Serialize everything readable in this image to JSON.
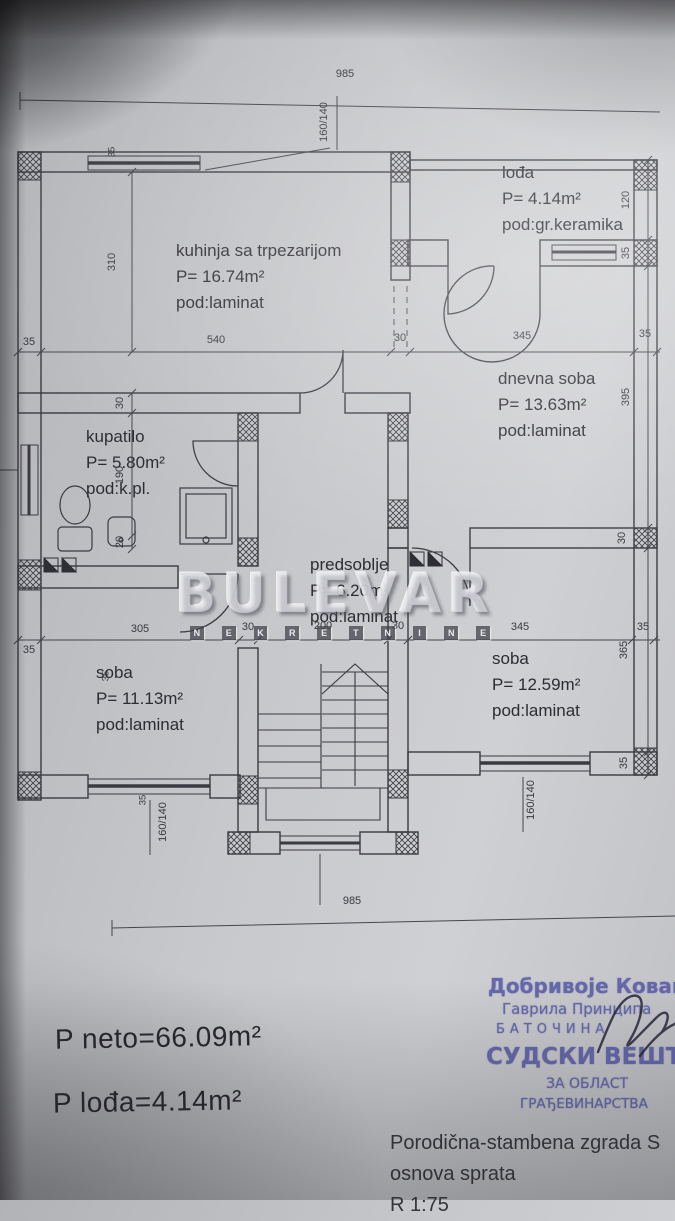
{
  "rooms": [
    {
      "name": "kuhinja sa trpezarijom",
      "area": "P= 16.74m²",
      "floor": "pod:laminat",
      "x": 176,
      "y": 238
    },
    {
      "name": "lođa",
      "area": "P= 4.14m²",
      "floor": "pod:gr.keramika",
      "x": 502,
      "y": 160
    },
    {
      "name": "dnevna soba",
      "area": "P= 13.63m²",
      "floor": "pod:laminat",
      "x": 498,
      "y": 366
    },
    {
      "name": "kupatilo",
      "area": "P= 5.80m²",
      "floor": "pod:k.pl.",
      "x": 86,
      "y": 424
    },
    {
      "name": "predsoblje",
      "area": "P= 6.20m²",
      "floor": "pod:laminat",
      "x": 310,
      "y": 552
    },
    {
      "name": "soba",
      "area": "P= 11.13m²",
      "floor": "pod:laminat",
      "x": 96,
      "y": 660
    },
    {
      "name": "soba",
      "area": "P= 12.59m²",
      "floor": "pod:laminat",
      "x": 492,
      "y": 646
    }
  ],
  "dims": [
    {
      "v": "985",
      "x": 345,
      "y": 74
    },
    {
      "v": "160/140",
      "x": 324,
      "y": 122,
      "r": 1
    },
    {
      "v": "35",
      "x": 112,
      "y": 152,
      "r": 1,
      "s": 1
    },
    {
      "v": "310",
      "x": 112,
      "y": 262,
      "r": 1
    },
    {
      "v": "35",
      "x": 29,
      "y": 342
    },
    {
      "v": "540",
      "x": 216,
      "y": 340
    },
    {
      "v": "30",
      "x": 400,
      "y": 338
    },
    {
      "v": "345",
      "x": 522,
      "y": 336
    },
    {
      "v": "35",
      "x": 645,
      "y": 334
    },
    {
      "v": "120",
      "x": 626,
      "y": 200,
      "r": 1
    },
    {
      "v": "35",
      "x": 626,
      "y": 253,
      "r": 1
    },
    {
      "v": "395",
      "x": 626,
      "y": 397,
      "r": 1
    },
    {
      "v": "30",
      "x": 622,
      "y": 538,
      "r": 1
    },
    {
      "v": "30",
      "x": 120,
      "y": 403,
      "r": 1
    },
    {
      "v": "190",
      "x": 120,
      "y": 475,
      "r": 1
    },
    {
      "v": "20",
      "x": 120,
      "y": 542,
      "r": 1
    },
    {
      "v": "35",
      "x": 29,
      "y": 650
    },
    {
      "v": "305",
      "x": 140,
      "y": 629
    },
    {
      "v": "30",
      "x": 248,
      "y": 627
    },
    {
      "v": "200",
      "x": 323,
      "y": 626
    },
    {
      "v": "30",
      "x": 398,
      "y": 626
    },
    {
      "v": "345",
      "x": 520,
      "y": 627
    },
    {
      "v": "35",
      "x": 643,
      "y": 627
    },
    {
      "v": "35",
      "x": 106,
      "y": 676,
      "r": 1,
      "s": 1
    },
    {
      "v": "365",
      "x": 624,
      "y": 650,
      "r": 1
    },
    {
      "v": "35",
      "x": 624,
      "y": 763,
      "r": 1
    },
    {
      "v": "160/140",
      "x": 163,
      "y": 822,
      "r": 1
    },
    {
      "v": "35",
      "x": 143,
      "y": 800,
      "r": 1,
      "s": 1
    },
    {
      "v": "160/140",
      "x": 531,
      "y": 800,
      "r": 1
    },
    {
      "v": "985",
      "x": 352,
      "y": 901
    }
  ],
  "watermark": {
    "word": "BULEVAR",
    "letters": [
      "N",
      "E",
      "K",
      "R",
      "E",
      "T",
      "N",
      "I",
      "N",
      "E"
    ]
  },
  "summary": {
    "neto": "P neto=66.09m²",
    "lodja": "P lođa=4.14m²"
  },
  "stamp": {
    "lines": [
      "Добривоје Кованс",
      "Гаврила Принципа",
      "БАТОЧИНА",
      "СУДСКИ ВЕШТА",
      "ЗА ОБЛАСТ",
      "ГРАЂЕВИНАРСТВА"
    ]
  },
  "titleblock": {
    "line1": "Porodična-stambena zgrada S",
    "line2": "osnova sprata",
    "line3": "R 1:75"
  },
  "colors": {
    "paper": "#c6c7ca",
    "ink": "#3a3a41",
    "dimension_ink": "#45454c",
    "stamp_blue": "#5d60a8",
    "signature_ink": "#26263a"
  }
}
